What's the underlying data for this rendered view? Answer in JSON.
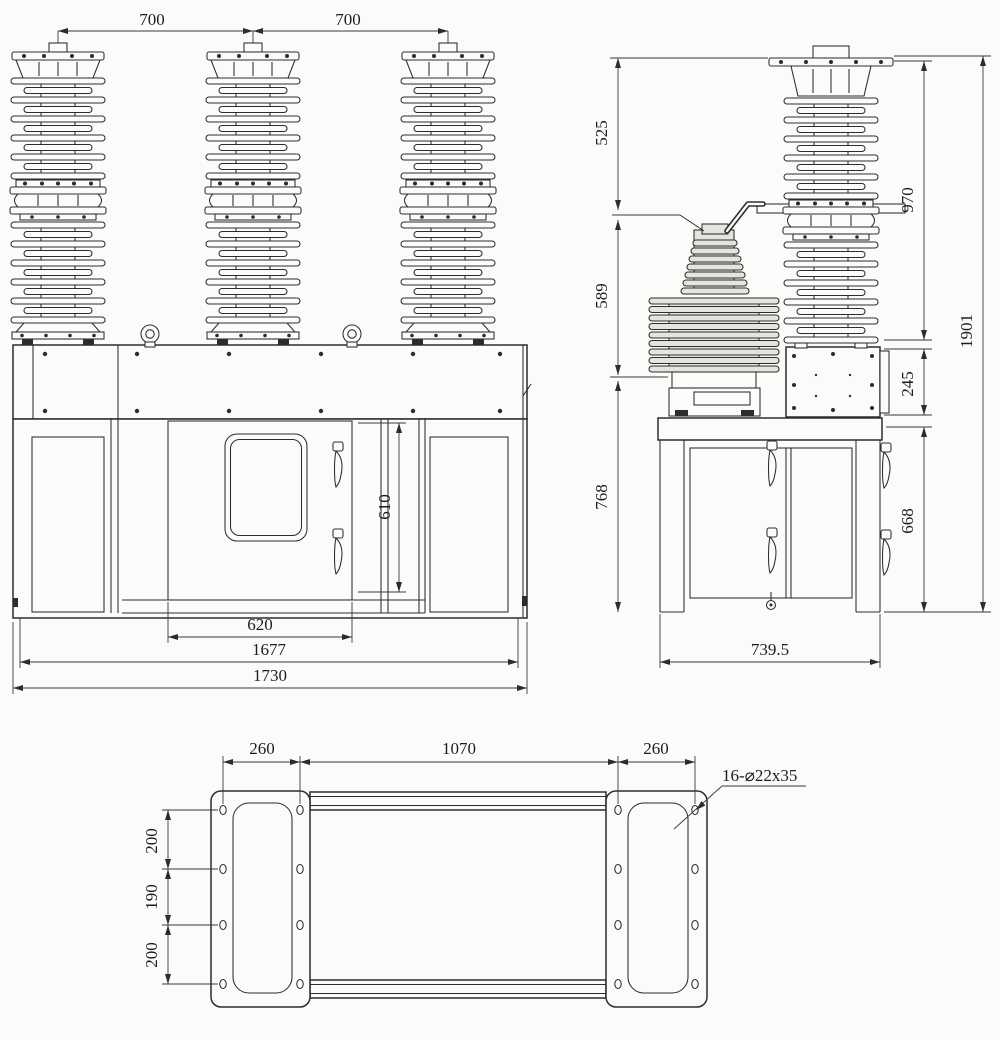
{
  "drawing": {
    "title": "vacuum-circuit-breaker-outline-drawing",
    "front_view": {
      "dim_pole_pitch_left": "700",
      "dim_pole_pitch_right": "700",
      "dim_door_height": "610",
      "dim_door_width": "620",
      "dim_inner_width": "1677",
      "dim_overall_width": "1730"
    },
    "side_view": {
      "dim_cap_to_terminal": "525",
      "dim_terminal_to_ct": "589",
      "dim_frame_height": "768",
      "dim_bushing_height": "970",
      "dim_mech_box_height": "245",
      "dim_cabinet_height": "668",
      "dim_overall_height": "1901",
      "dim_base_depth": "739.5"
    },
    "bottom_view": {
      "dim_left_hole_span": "260",
      "dim_center_hole_span": "1070",
      "dim_right_hole_span": "260",
      "dim_hole_row_top": "200",
      "dim_hole_row_mid": "190",
      "dim_hole_row_bottom": "200",
      "hole_note": "16-⌀22x35"
    },
    "colors": {
      "line": "#2c2c2c",
      "background": "#fbfbf9",
      "component_fill": "#e4e4e0"
    }
  }
}
